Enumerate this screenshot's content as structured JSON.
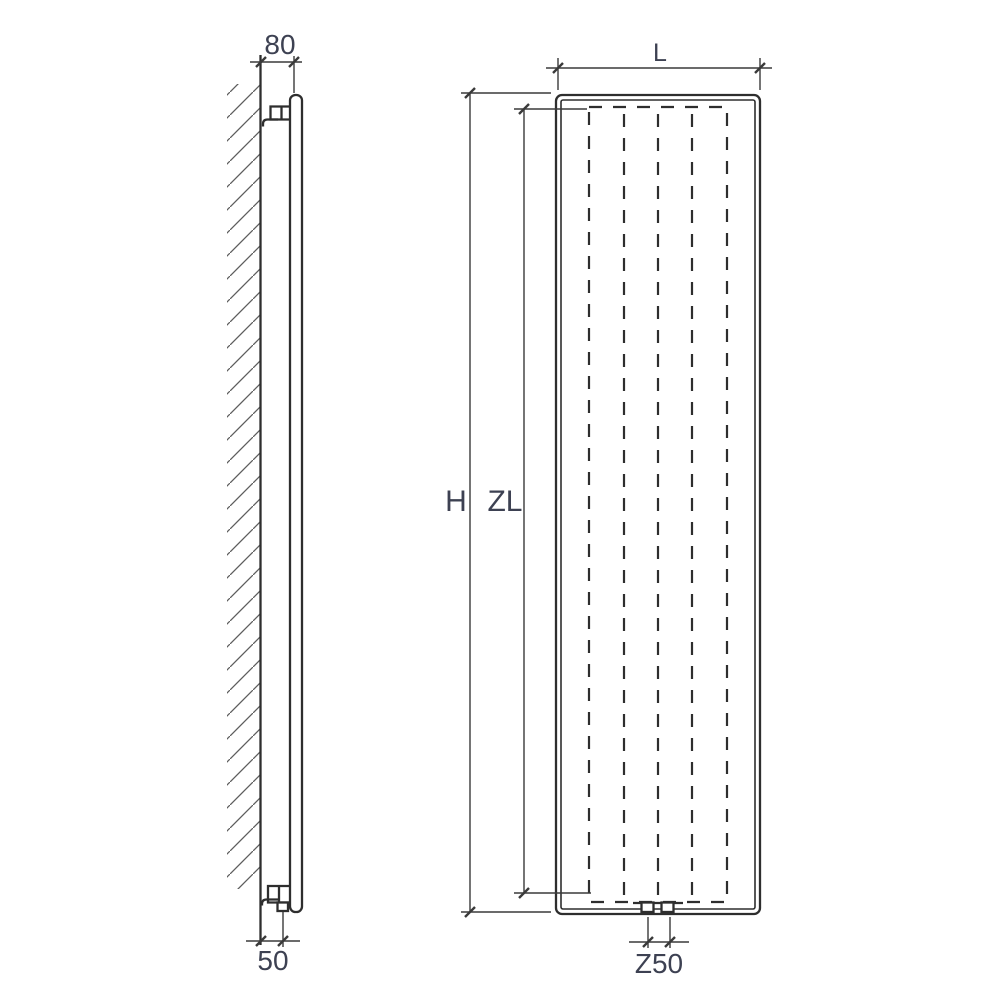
{
  "drawing": {
    "side_view": {
      "wall_offset_top": "80",
      "wall_offset_bottom": "50"
    },
    "front_view": {
      "width_label": "L",
      "overall_height_label": "H",
      "convector_height_label": "ZL",
      "connection_spacing_label": "Z50"
    },
    "colors": {
      "object_line": "#2e2e2e",
      "dimension_line": "#3a3a3a",
      "hatch_line": "#5d5d5d",
      "label_text": "#3d4152",
      "background": "#ffffff"
    }
  }
}
